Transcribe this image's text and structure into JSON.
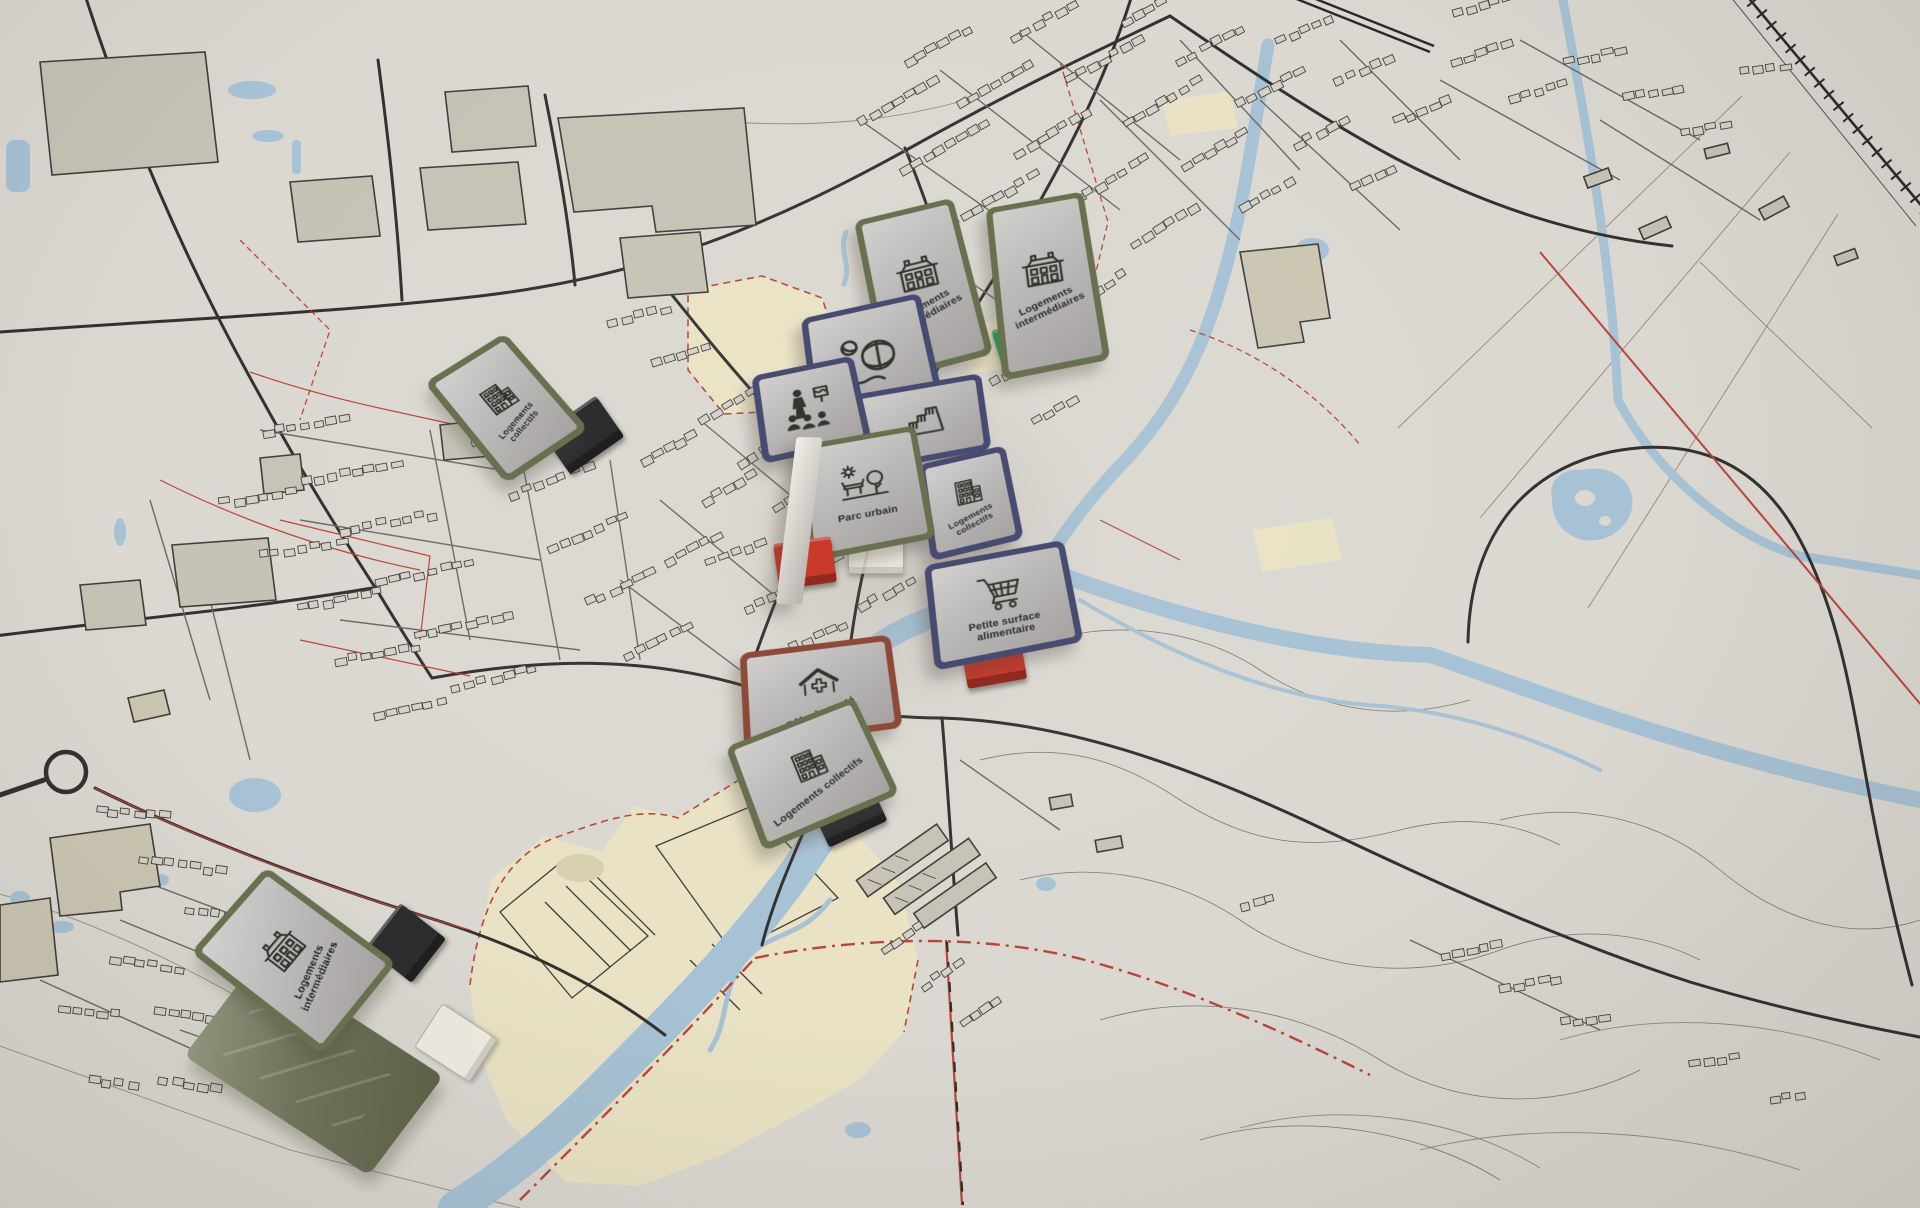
{
  "scene": {
    "description": "Photo of a printed town-planning map with standing project marker cards",
    "language": "fr"
  },
  "map": {
    "paper_color": "#dbd8d1",
    "road_color": "#33312d",
    "minor_road_color": "#6b6962",
    "water_color": "#a7c2d5",
    "zone_color": "#e9e2c4",
    "boundary_color": "#b9453c",
    "building_color": "#c6c2b6"
  },
  "markers": [
    {
      "id": "logements-collectifs-west",
      "label": "Logements collectifs",
      "icon": "apartment-building-icon",
      "border_color": "#68704f",
      "base": "black-stand",
      "base_color": "#2c2c2e"
    },
    {
      "id": "logements-intermediaires-north-left",
      "label": "Logements intermédiaires",
      "icon": "house-building-icon",
      "border_color": "#68704f"
    },
    {
      "id": "logements-intermediaires-north-right",
      "label": "Logements intermédiaires",
      "icon": "house-building-icon",
      "border_color": "#68704f",
      "base": "green-stand",
      "base_color": "#28a35d"
    },
    {
      "id": "carte-sport",
      "label": "",
      "icon": "basketball-icon",
      "border_color": "#474b70"
    },
    {
      "id": "carte-groupe-personnes",
      "label": "",
      "icon": "people-group-icon",
      "border_color": "#474b70"
    },
    {
      "id": "carte-tribune",
      "label": "",
      "icon": "bleachers-icon",
      "border_color": "#474b70"
    },
    {
      "id": "parc-urbain",
      "label": "Parc urbain",
      "icon": "park-icon",
      "border_color": "#68704f",
      "base": "clear-clip",
      "base_color": "#e8e4d7"
    },
    {
      "id": "logements-collectifs-center",
      "label": "Logements collectifs",
      "icon": "apartment-building-icon",
      "border_color": "#474b70"
    },
    {
      "id": "petite-surface-alimentaire",
      "label": "Petite surface alimentaire",
      "icon": "shopping-cart-icon",
      "border_color": "#474b70",
      "base": "red-stand",
      "base_color": "#c9392b"
    },
    {
      "id": "pole-de-sante",
      "label": "Pôle de santé",
      "icon": "health-center-icon",
      "border_color": "#8d4a38"
    },
    {
      "id": "logements-collectifs-south",
      "label": "Logements collectifs",
      "icon": "apartment-building-icon",
      "border_color": "#68704f",
      "base": "black-stand",
      "base_color": "#2c2c2e"
    },
    {
      "id": "carte-tranche-blanche",
      "label": "",
      "icon": "",
      "border_color": "#d9d6cf",
      "base": "red-stand",
      "base_color": "#c9392b"
    },
    {
      "id": "logements-intermediaires-southwest",
      "label": "Logements intermédiaires",
      "icon": "house-building-icon",
      "border_color": "#68704f",
      "base": "black-stand",
      "base_color": "#2c2c2e"
    },
    {
      "id": "carte-dos",
      "label": "",
      "icon": "",
      "border_color": "#6d7257",
      "base": "clear-clip",
      "base_color": "#dedacd"
    }
  ]
}
